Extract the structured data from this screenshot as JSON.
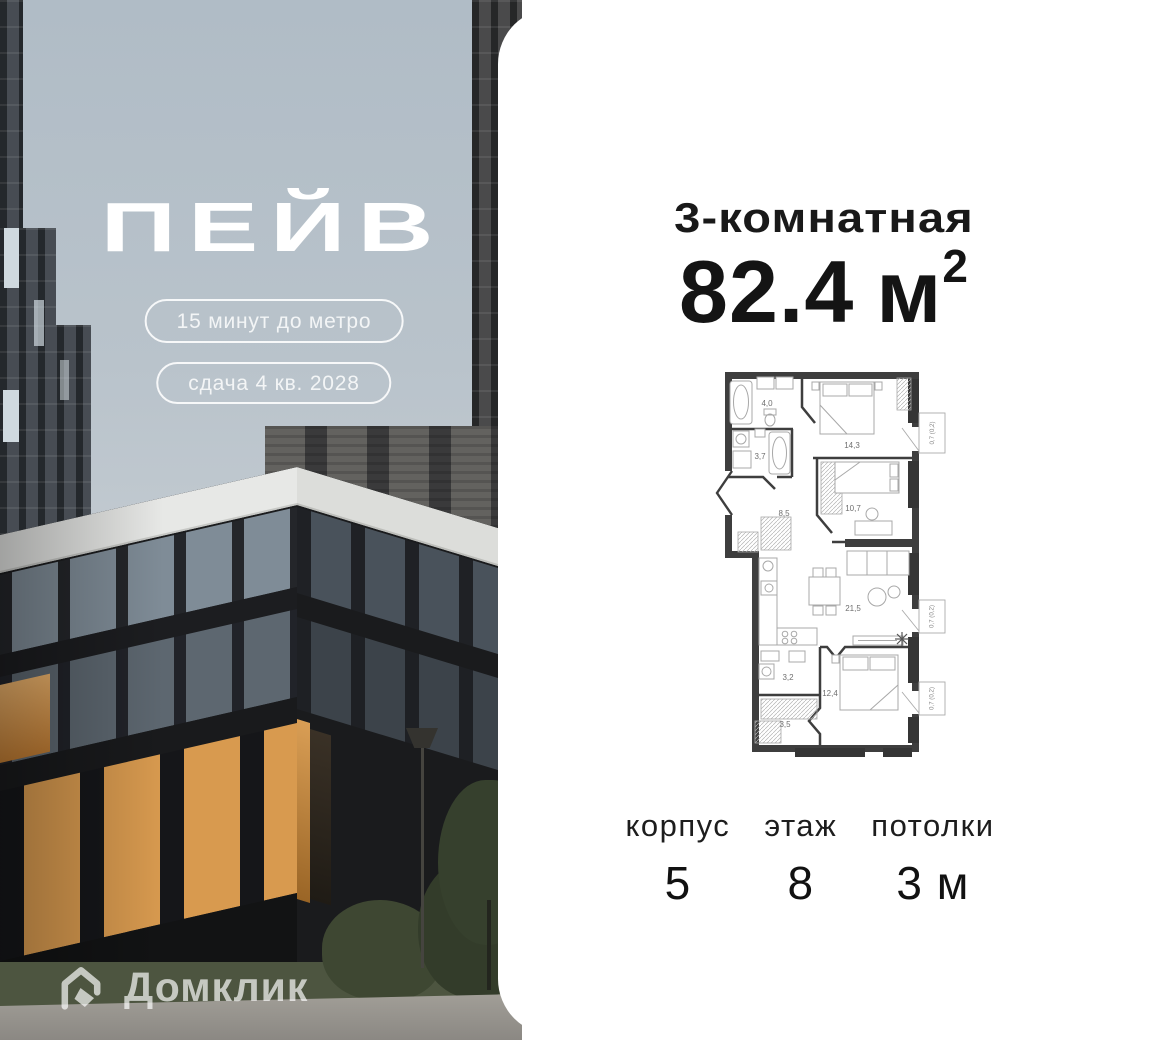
{
  "project": {
    "name": "ПЕЙВ",
    "badges": [
      {
        "label": "15 минут до метро"
      },
      {
        "label": "сдача 4 кв. 2028"
      }
    ]
  },
  "watermark": {
    "brand": "Домклик"
  },
  "card": {
    "title": "3-комнатная",
    "area": {
      "value": "82.4",
      "unit": "м",
      "superscript": "2"
    },
    "stats": [
      {
        "label": "корпус",
        "value": "5"
      },
      {
        "label": "этаж",
        "value": "8"
      },
      {
        "label": "потолки",
        "value": "3 м"
      }
    ]
  },
  "floorplan": {
    "rooms": [
      {
        "name": "bathroom",
        "area": "4,0"
      },
      {
        "name": "bathroom-2",
        "area": "3,7"
      },
      {
        "name": "bedroom-1",
        "area": "14,3"
      },
      {
        "name": "bedroom-2",
        "area": "10,7"
      },
      {
        "name": "hallway",
        "area": "8,5"
      },
      {
        "name": "living-kitchen",
        "area": "21,5"
      },
      {
        "name": "laundry",
        "area": "3,2"
      },
      {
        "name": "bedroom-3",
        "area": "12,4"
      },
      {
        "name": "wardrobe",
        "area": "3,5"
      }
    ],
    "balconies": [
      {
        "label": "0,7 (0,2)"
      },
      {
        "label": "0,7 (0,2)"
      },
      {
        "label": "0,7 (0,2)"
      }
    ]
  },
  "colors": {
    "card_bg": "#ffffff",
    "text": "#191919",
    "wall": "#3e3e3e",
    "furniture": "#a8a8a8",
    "room_label": "#6f6f6f",
    "window_glow": "#d89a4f",
    "sky": "#b4bfc8"
  }
}
